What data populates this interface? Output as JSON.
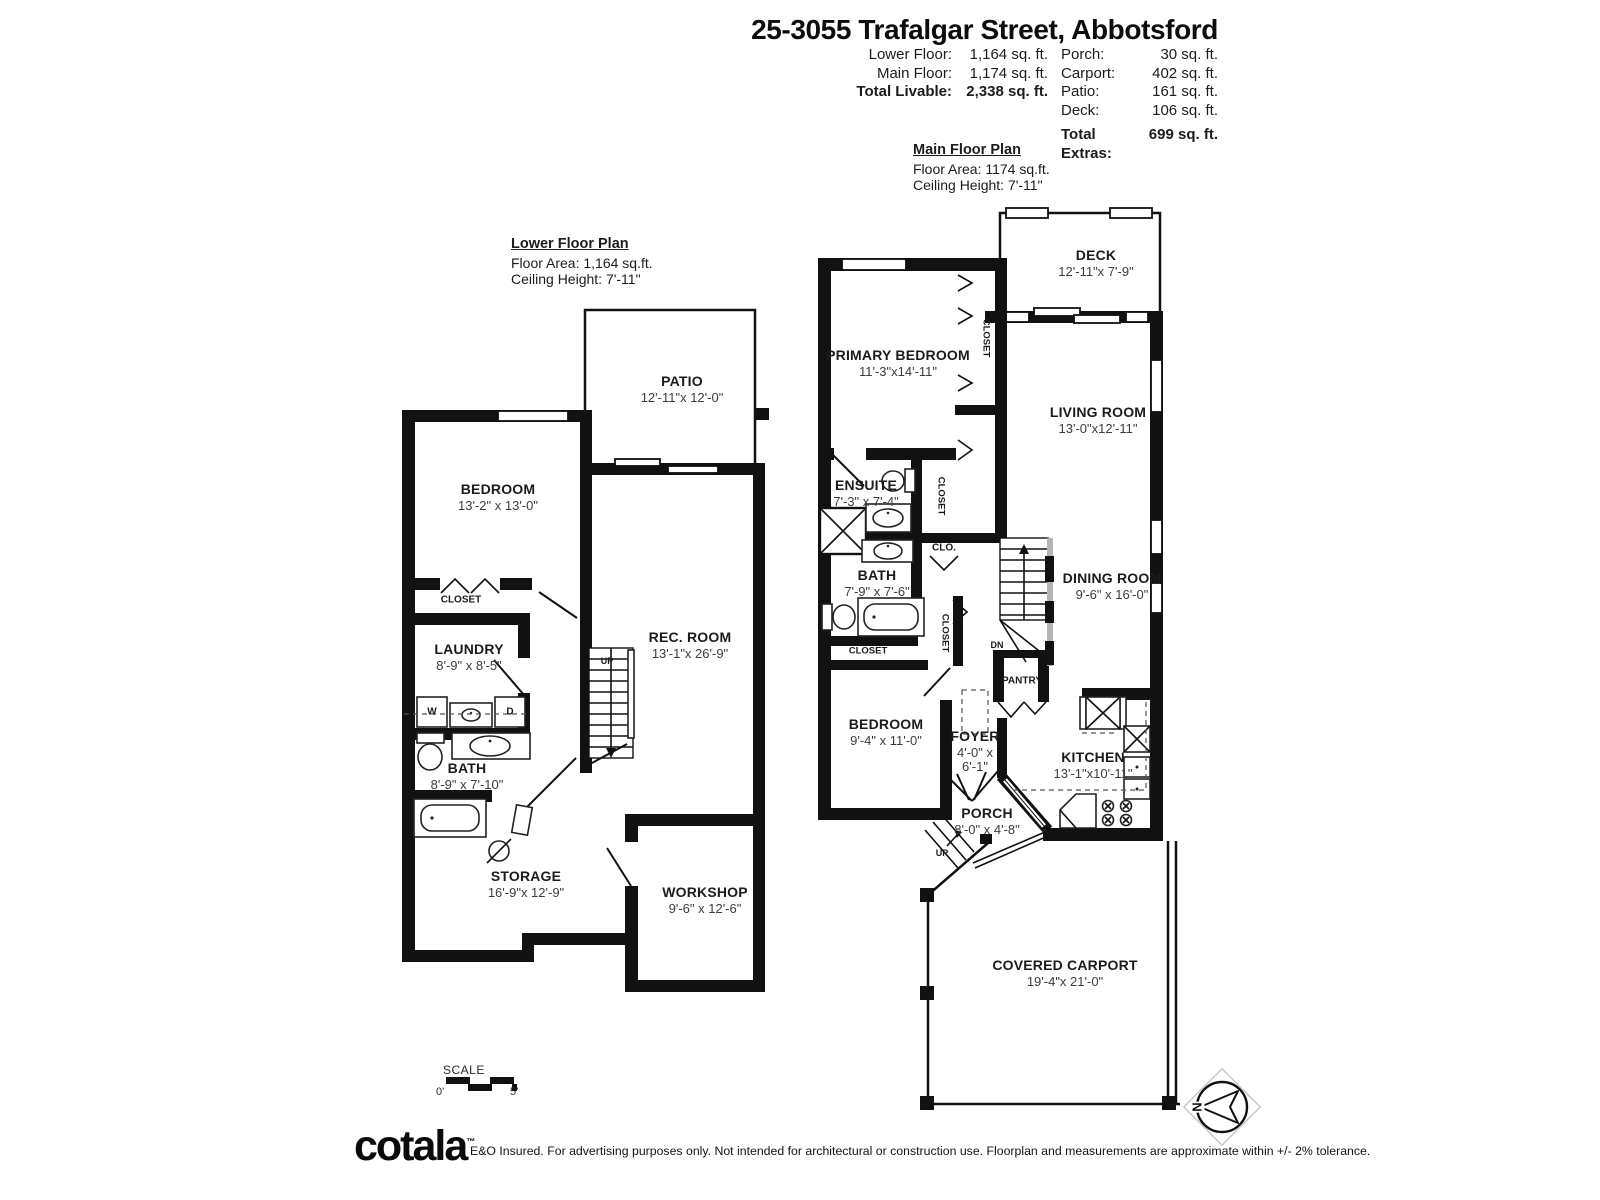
{
  "header": {
    "title": "25-3055 Trafalgar Street, Abbotsford",
    "left_stats": {
      "rows": [
        {
          "label": "Lower Floor:",
          "value": "1,164 sq. ft."
        },
        {
          "label": "Main Floor:",
          "value": "1,174 sq. ft."
        }
      ],
      "total": {
        "label": "Total Livable:",
        "value": "2,338 sq. ft."
      }
    },
    "right_stats": {
      "rows": [
        {
          "label": "Porch:",
          "value": "30 sq. ft."
        },
        {
          "label": "Carport:",
          "value": "402 sq. ft."
        },
        {
          "label": "Patio:",
          "value": "161 sq. ft."
        },
        {
          "label": "Deck:",
          "value": "106 sq. ft."
        }
      ],
      "total": {
        "label": "Total Extras:",
        "value": "699 sq. ft."
      }
    }
  },
  "main_plan": {
    "title": "Main Floor Plan",
    "floor_area": "Floor Area: 1174 sq.ft.",
    "ceiling_height": "Ceiling Height: 7'-11\"",
    "rooms": {
      "deck": {
        "name": "DECK",
        "dims": "12'-11\"x 7'-9\""
      },
      "primary_bedroom": {
        "name": "PRIMARY BEDROOM",
        "dims": "11'-3\"x14'-11\""
      },
      "living_room": {
        "name": "LIVING ROOM",
        "dims": "13'-0\"x12'-11\""
      },
      "ensuite": {
        "name": "ENSUITE",
        "dims": "7'-3\" x 7'-4\""
      },
      "bath": {
        "name": "BATH",
        "dims": "7'-9\" x 7'-6\""
      },
      "dining_room": {
        "name": "DINING ROOM",
        "dims": "9'-6\" x 16'-0\""
      },
      "bedroom": {
        "name": "BEDROOM",
        "dims": "9'-4\" x 11'-0\""
      },
      "foyer": {
        "name": "FOYER",
        "dims_line1": "4'-0\" x",
        "dims_line2": "6'-1\""
      },
      "kitchen": {
        "name": "KITCHEN",
        "dims": "13'-1\"x10'-11\""
      },
      "porch": {
        "name": "PORCH",
        "dims": "8'-0\" x 4'-8\""
      },
      "pantry": {
        "name": "PANTRY"
      },
      "carport": {
        "name": "COVERED CARPORT",
        "dims": "19'-4\"x 21'-0\""
      }
    }
  },
  "lower_plan": {
    "title": "Lower Floor Plan",
    "floor_area": "Floor Area: 1,164 sq.ft.",
    "ceiling_height": "Ceiling Height: 7'-11\"",
    "rooms": {
      "patio": {
        "name": "PATIO",
        "dims": "12'-11\"x 12'-0\""
      },
      "bedroom": {
        "name": "BEDROOM",
        "dims": "13'-2\" x 13'-0\""
      },
      "laundry": {
        "name": "LAUNDRY",
        "dims": "8'-9\" x 8'-5\""
      },
      "bath": {
        "name": "BATH",
        "dims": "8'-9\" x 7'-10\""
      },
      "rec_room": {
        "name": "REC. ROOM",
        "dims": "13'-1\"x 26'-9\""
      },
      "storage": {
        "name": "STORAGE",
        "dims": "16'-9\"x 12'-9\""
      },
      "workshop": {
        "name": "WORKSHOP",
        "dims": "9'-6\" x 12'-6\""
      }
    }
  },
  "small_labels": {
    "closet": "CLOSET",
    "clo": "CLO.",
    "pantry": "PANTRY",
    "up": "UP",
    "dn": "DN",
    "washer": "W",
    "dryer": "D"
  },
  "scale": {
    "label": "SCALE",
    "start": "0'",
    "end": "5'"
  },
  "compass": {
    "north": "N"
  },
  "footer": {
    "logo": "cotala",
    "tm": "™",
    "disclaimer": "E&O Insured. For advertising purposes only. Not intended for architectural or construction use. Floorplan and measurements are approximate within +/- 2% tolerance."
  },
  "colors": {
    "wall": "#111111",
    "dim_text": "#3c3c3c",
    "background": "#ffffff"
  }
}
